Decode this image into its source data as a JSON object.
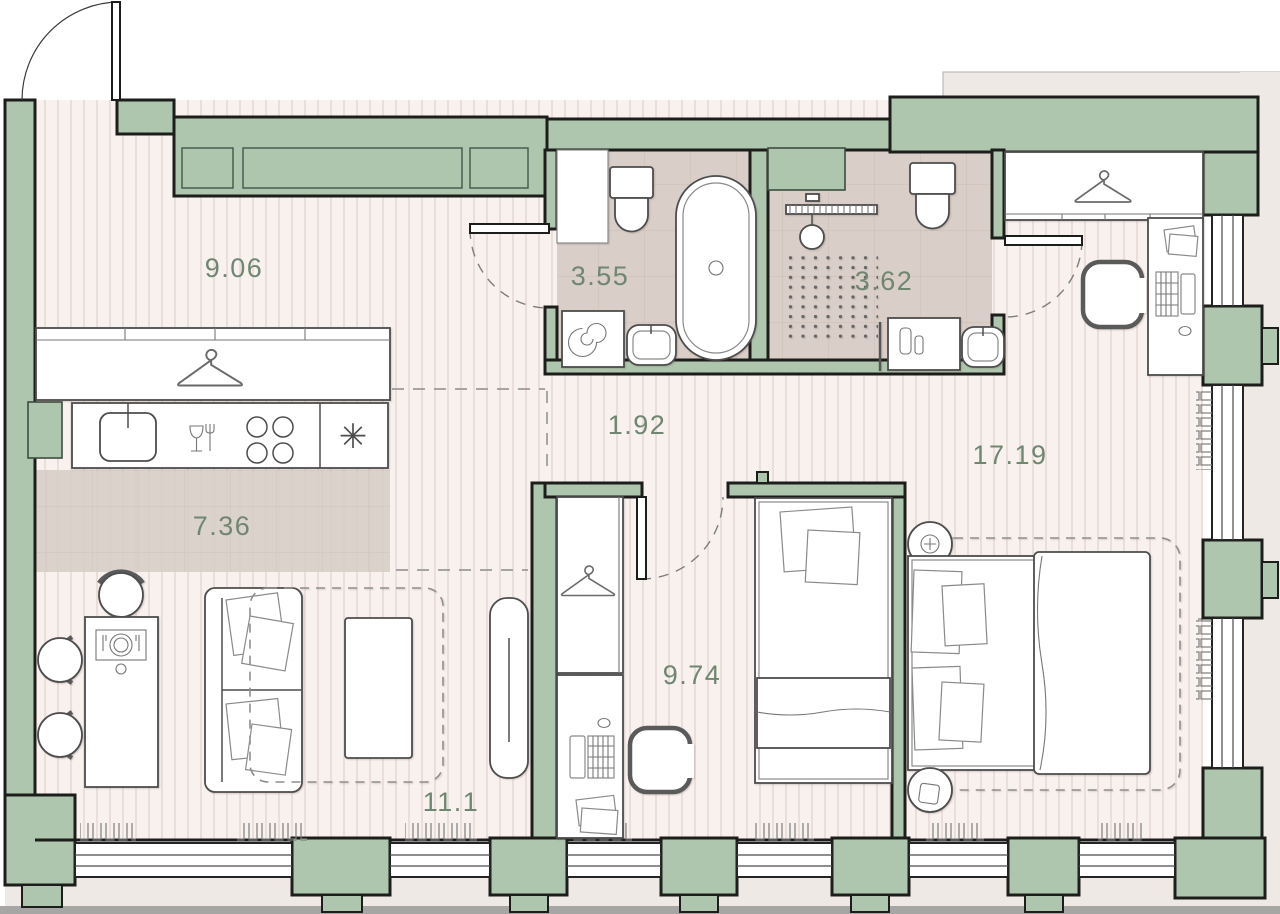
{
  "plan": {
    "title": "apartment-floor-plan",
    "rooms": [
      {
        "id": "kitchen-living",
        "label": "9.06"
      },
      {
        "id": "bathroom",
        "label": "3.55"
      },
      {
        "id": "shower-room",
        "label": "3.62"
      },
      {
        "id": "hallway",
        "label": "1.92"
      },
      {
        "id": "bedroom-main",
        "label": "17.19"
      },
      {
        "id": "kitchen-zone",
        "label": "7.36"
      },
      {
        "id": "bedroom-second",
        "label": "9.74"
      },
      {
        "id": "living-zone",
        "label": "11.1"
      }
    ],
    "icons": {
      "fridge-icon": "✳"
    },
    "colors": {
      "wall": "#aec6ad",
      "wall-outline": "#1d1d1b",
      "floor": "#f8f1ee",
      "floor-stripe": "#e7d9d5",
      "tile": "#d9cec8",
      "tile-line": "#cabdb5",
      "exterior": "#efe9e5",
      "ground": "#a6a6a4",
      "furniture-line": "#4d4d4d",
      "label": "#6f8770",
      "dash": "#8a8a8a"
    }
  }
}
